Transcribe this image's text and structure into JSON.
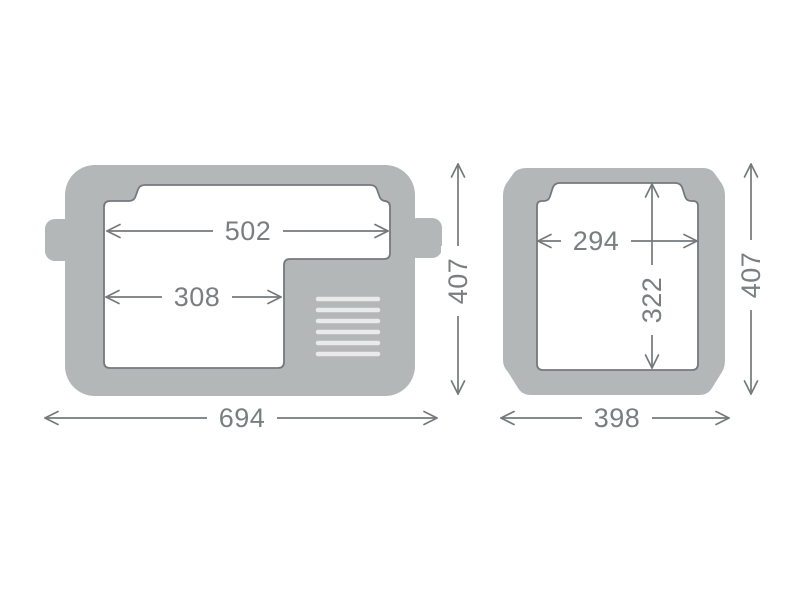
{
  "diagram": {
    "type": "product-dimension-drawing",
    "views": {
      "side_view": {
        "dimensions": {
          "inner_top_width": "502",
          "inner_lower_width": "308",
          "outer_width": "694",
          "outer_height": "407"
        },
        "features": [
          "carry-handle-tabs",
          "vent-grille-6-slots",
          "lid-seal-cutout"
        ]
      },
      "front_view": {
        "dimensions": {
          "inner_width": "294",
          "inner_height": "322",
          "outer_width": "398",
          "outer_height": "407"
        },
        "features": [
          "lid-seal-cutout"
        ]
      }
    },
    "colors": {
      "body_fill": "#b4b7b8",
      "outline": "#75797c",
      "dimension_line": "#75797c",
      "dimension_text": "#7a7e80",
      "vent": "#e9eaea",
      "background": "#ffffff"
    }
  }
}
